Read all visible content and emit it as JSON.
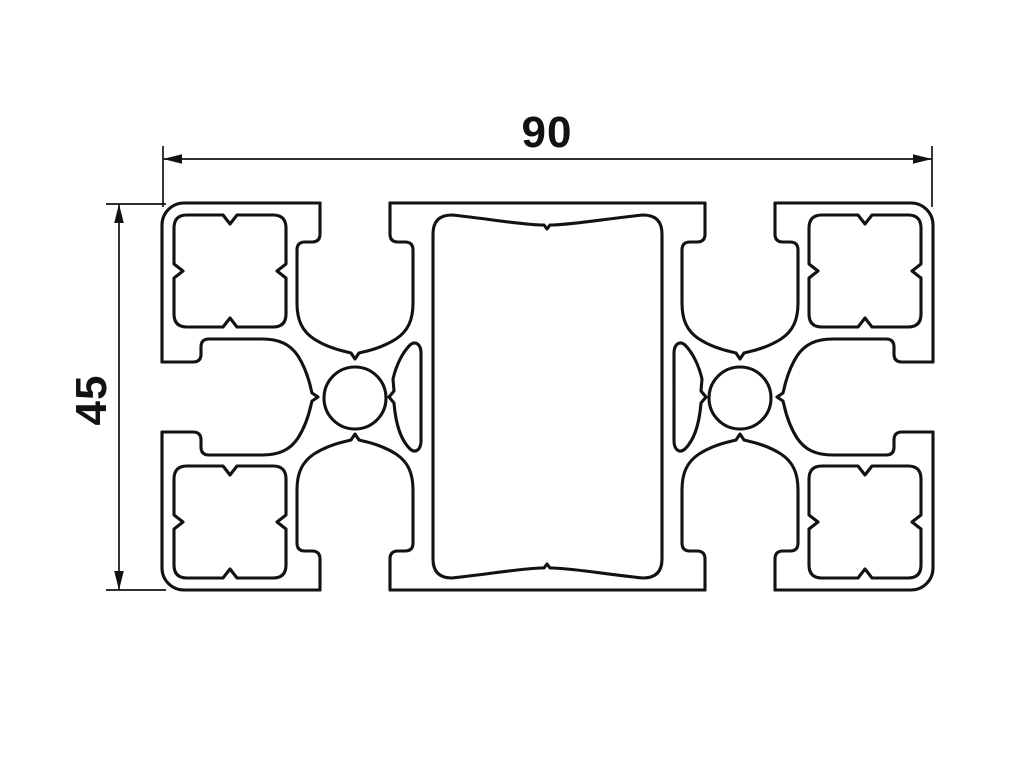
{
  "colors": {
    "line": "#121212",
    "background": "#ffffff"
  },
  "drawing": {
    "type": "technical-cross-section",
    "dimensions": {
      "width_label": "90",
      "height_label": "45"
    }
  }
}
